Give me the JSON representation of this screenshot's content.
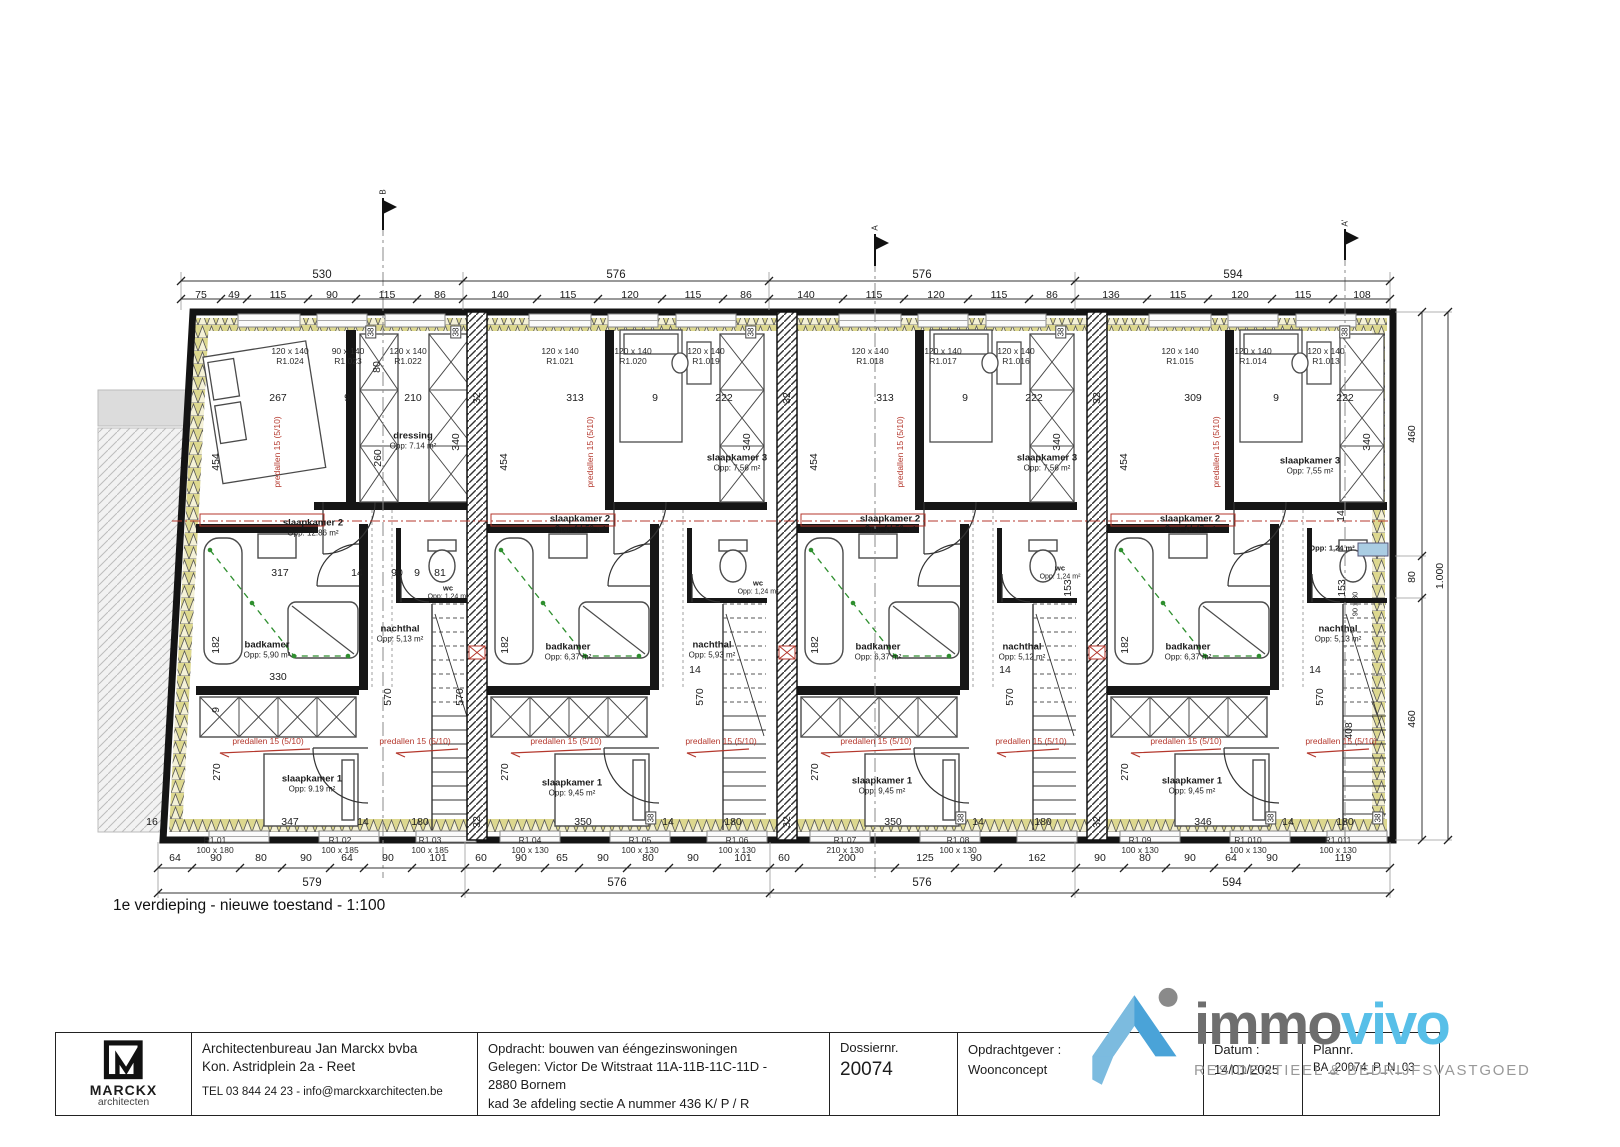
{
  "caption": "1e verdieping - nieuwe toestand - 1:100",
  "title_block": {
    "logo": {
      "brand": "MARCKX",
      "sub": "architecten"
    },
    "architect": {
      "line1": "Architectenbureau Jan Marckx bvba",
      "line2": "Kon. Astridplein 2a - Reet",
      "line3": "TEL 03 844 24 23 - info@marckxarchitecten.be"
    },
    "opdracht": {
      "line1": "Opdracht: bouwen van ééngezinswoningen",
      "line2": "Gelegen: Victor De Witstraat 11A-11B-11C-11D -",
      "line3": "2880 Bornem",
      "line4": "kad 3e afdeling sectie A nummer 436 K/ P / R"
    },
    "dossier": {
      "label": "Dossiernr.",
      "value": "20074"
    },
    "opdrachtgever": {
      "label": "Opdrachtgever :",
      "value": "Woonconcept"
    },
    "datum": {
      "label": "Datum :",
      "value": "14/01/2025"
    },
    "plannr": {
      "label": "Plannr.",
      "value": "BA_20074_P_N_03"
    }
  },
  "immovivo": {
    "immo": "immo",
    "vivo": "vivo",
    "tagline": "RESIDENTIEEL & BEDRIJFSVASTGOED"
  },
  "colors": {
    "accent_red": "#b4372c",
    "plumbing_green": "#2f8f2f",
    "brand_blue": "#58bfe8",
    "brand_gray": "#6e6e6e"
  },
  "plan_labels": [
    {
      "t": "530",
      "x": 322,
      "y": 276,
      "c": "tot"
    },
    {
      "t": "576",
      "x": 616,
      "y": 276,
      "c": "tot"
    },
    {
      "t": "576",
      "x": 922,
      "y": 276,
      "c": "tot"
    },
    {
      "t": "594",
      "x": 1233,
      "y": 276,
      "c": "tot"
    },
    {
      "t": "75",
      "x": 201,
      "y": 295
    },
    {
      "t": "49",
      "x": 234,
      "y": 295
    },
    {
      "t": "115",
      "x": 278,
      "y": 295
    },
    {
      "t": "90",
      "x": 332,
      "y": 295
    },
    {
      "t": "115",
      "x": 387,
      "y": 295
    },
    {
      "t": "86",
      "x": 440,
      "y": 295
    },
    {
      "t": "140",
      "x": 500,
      "y": 295
    },
    {
      "t": "115",
      "x": 568,
      "y": 295
    },
    {
      "t": "120",
      "x": 630,
      "y": 295
    },
    {
      "t": "115",
      "x": 693,
      "y": 295
    },
    {
      "t": "86",
      "x": 746,
      "y": 295
    },
    {
      "t": "140",
      "x": 806,
      "y": 295
    },
    {
      "t": "115",
      "x": 874,
      "y": 295
    },
    {
      "t": "120",
      "x": 936,
      "y": 295
    },
    {
      "t": "115",
      "x": 999,
      "y": 295
    },
    {
      "t": "86",
      "x": 1052,
      "y": 295
    },
    {
      "t": "136",
      "x": 1111,
      "y": 295
    },
    {
      "t": "115",
      "x": 1178,
      "y": 295
    },
    {
      "t": "120",
      "x": 1240,
      "y": 295
    },
    {
      "t": "115",
      "x": 1303,
      "y": 295
    },
    {
      "t": "108",
      "x": 1362,
      "y": 295
    },
    {
      "t": "64",
      "x": 175,
      "y": 858
    },
    {
      "t": "90",
      "x": 216,
      "y": 858
    },
    {
      "t": "80",
      "x": 261,
      "y": 858
    },
    {
      "t": "90",
      "x": 306,
      "y": 858
    },
    {
      "t": "64",
      "x": 347,
      "y": 858
    },
    {
      "t": "90",
      "x": 388,
      "y": 858
    },
    {
      "t": "101",
      "x": 438,
      "y": 858
    },
    {
      "t": "60",
      "x": 481,
      "y": 858
    },
    {
      "t": "90",
      "x": 521,
      "y": 858
    },
    {
      "t": "65",
      "x": 562,
      "y": 858
    },
    {
      "t": "90",
      "x": 603,
      "y": 858
    },
    {
      "t": "80",
      "x": 648,
      "y": 858
    },
    {
      "t": "90",
      "x": 693,
      "y": 858
    },
    {
      "t": "101",
      "x": 743,
      "y": 858
    },
    {
      "t": "60",
      "x": 784,
      "y": 858
    },
    {
      "t": "200",
      "x": 847,
      "y": 858
    },
    {
      "t": "125",
      "x": 925,
      "y": 858
    },
    {
      "t": "90",
      "x": 976,
      "y": 858
    },
    {
      "t": "162",
      "x": 1037,
      "y": 858
    },
    {
      "t": "90",
      "x": 1100,
      "y": 858
    },
    {
      "t": "80",
      "x": 1145,
      "y": 858
    },
    {
      "t": "90",
      "x": 1190,
      "y": 858
    },
    {
      "t": "64",
      "x": 1231,
      "y": 858
    },
    {
      "t": "90",
      "x": 1272,
      "y": 858
    },
    {
      "t": "119",
      "x": 1343,
      "y": 858
    },
    {
      "t": "579",
      "x": 312,
      "y": 884,
      "c": "tot"
    },
    {
      "t": "576",
      "x": 617,
      "y": 884,
      "c": "tot"
    },
    {
      "t": "576",
      "x": 922,
      "y": 884,
      "c": "tot"
    },
    {
      "t": "594",
      "x": 1232,
      "y": 884,
      "c": "tot"
    },
    {
      "t": "460",
      "x": 1412,
      "y": 434,
      "c": "rot"
    },
    {
      "t": "80",
      "x": 1412,
      "y": 577,
      "c": "rot"
    },
    {
      "t": "460",
      "x": 1412,
      "y": 719,
      "c": "rot"
    },
    {
      "t": "1.000",
      "x": 1440,
      "y": 576,
      "c": "rot"
    },
    {
      "t": "16",
      "x": 152,
      "y": 822
    },
    {
      "t": "267",
      "x": 278,
      "y": 398
    },
    {
      "t": "9",
      "x": 347,
      "y": 398
    },
    {
      "t": "210",
      "x": 413,
      "y": 398
    },
    {
      "t": "313",
      "x": 575,
      "y": 398
    },
    {
      "t": "9",
      "x": 655,
      "y": 398
    },
    {
      "t": "222",
      "x": 724,
      "y": 398
    },
    {
      "t": "313",
      "x": 885,
      "y": 398
    },
    {
      "t": "9",
      "x": 965,
      "y": 398
    },
    {
      "t": "222",
      "x": 1034,
      "y": 398
    },
    {
      "t": "309",
      "x": 1193,
      "y": 398
    },
    {
      "t": "9",
      "x": 1276,
      "y": 398
    },
    {
      "t": "222",
      "x": 1345,
      "y": 398
    },
    {
      "t": "454",
      "x": 216,
      "y": 462,
      "c": "rot"
    },
    {
      "t": "454",
      "x": 504,
      "y": 462,
      "c": "rot"
    },
    {
      "t": "454",
      "x": 814,
      "y": 462,
      "c": "rot"
    },
    {
      "t": "454",
      "x": 1124,
      "y": 462,
      "c": "rot"
    },
    {
      "t": "260",
      "x": 378,
      "y": 458,
      "c": "rot"
    },
    {
      "t": "80",
      "x": 377,
      "y": 367,
      "c": "rot"
    },
    {
      "t": "340",
      "x": 456,
      "y": 442,
      "c": "rot"
    },
    {
      "t": "340",
      "x": 747,
      "y": 442,
      "c": "rot"
    },
    {
      "t": "340",
      "x": 1057,
      "y": 442,
      "c": "rot"
    },
    {
      "t": "340",
      "x": 1367,
      "y": 442,
      "c": "rot"
    },
    {
      "t": "38",
      "x": 371,
      "y": 332,
      "c": "box"
    },
    {
      "t": "38",
      "x": 456,
      "y": 332,
      "c": "box"
    },
    {
      "t": "38",
      "x": 751,
      "y": 332,
      "c": "box"
    },
    {
      "t": "38",
      "x": 1061,
      "y": 332,
      "c": "box"
    },
    {
      "t": "38",
      "x": 1345,
      "y": 332,
      "c": "box"
    },
    {
      "t": "38",
      "x": 651,
      "y": 818,
      "c": "box"
    },
    {
      "t": "38",
      "x": 961,
      "y": 818,
      "c": "box"
    },
    {
      "t": "38",
      "x": 1271,
      "y": 818,
      "c": "box"
    },
    {
      "t": "38",
      "x": 1378,
      "y": 818,
      "c": "box"
    },
    {
      "t": "32",
      "x": 477,
      "y": 398,
      "c": "rot"
    },
    {
      "t": "32",
      "x": 787,
      "y": 398,
      "c": "rot"
    },
    {
      "t": "32",
      "x": 1097,
      "y": 398,
      "c": "rot"
    },
    {
      "t": "32",
      "x": 477,
      "y": 822,
      "c": "rot"
    },
    {
      "t": "32",
      "x": 787,
      "y": 822,
      "c": "rot"
    },
    {
      "t": "32",
      "x": 1097,
      "y": 822,
      "c": "rot"
    },
    {
      "t": "317",
      "x": 280,
      "y": 573
    },
    {
      "t": "14",
      "x": 357,
      "y": 573
    },
    {
      "t": "90",
      "x": 397,
      "y": 573
    },
    {
      "t": "9",
      "x": 417,
      "y": 573
    },
    {
      "t": "81",
      "x": 440,
      "y": 573
    },
    {
      "t": "182",
      "x": 216,
      "y": 645,
      "c": "rot"
    },
    {
      "t": "182",
      "x": 505,
      "y": 645,
      "c": "rot"
    },
    {
      "t": "182",
      "x": 815,
      "y": 645,
      "c": "rot"
    },
    {
      "t": "182",
      "x": 1125,
      "y": 645,
      "c": "rot"
    },
    {
      "t": "330",
      "x": 278,
      "y": 677
    },
    {
      "t": "570",
      "x": 388,
      "y": 697,
      "c": "rot"
    },
    {
      "t": "570",
      "x": 460,
      "y": 697,
      "c": "rot"
    },
    {
      "t": "570",
      "x": 700,
      "y": 697,
      "c": "rot"
    },
    {
      "t": "570",
      "x": 1010,
      "y": 697,
      "c": "rot"
    },
    {
      "t": "570",
      "x": 1320,
      "y": 697,
      "c": "rot"
    },
    {
      "t": "14",
      "x": 695,
      "y": 670
    },
    {
      "t": "14",
      "x": 1005,
      "y": 670
    },
    {
      "t": "14",
      "x": 1315,
      "y": 670
    },
    {
      "t": "9",
      "x": 216,
      "y": 710,
      "c": "rot"
    },
    {
      "t": "270",
      "x": 217,
      "y": 772,
      "c": "rot"
    },
    {
      "t": "270",
      "x": 505,
      "y": 772,
      "c": "rot"
    },
    {
      "t": "270",
      "x": 815,
      "y": 772,
      "c": "rot"
    },
    {
      "t": "270",
      "x": 1125,
      "y": 772,
      "c": "rot"
    },
    {
      "t": "347",
      "x": 290,
      "y": 822
    },
    {
      "t": "14",
      "x": 363,
      "y": 822
    },
    {
      "t": "180",
      "x": 420,
      "y": 822
    },
    {
      "t": "350",
      "x": 583,
      "y": 822
    },
    {
      "t": "14",
      "x": 668,
      "y": 822
    },
    {
      "t": "180",
      "x": 733,
      "y": 822
    },
    {
      "t": "350",
      "x": 893,
      "y": 822
    },
    {
      "t": "14",
      "x": 978,
      "y": 822
    },
    {
      "t": "180",
      "x": 1043,
      "y": 822
    },
    {
      "t": "346",
      "x": 1203,
      "y": 822
    },
    {
      "t": "14",
      "x": 1288,
      "y": 822
    },
    {
      "t": "180",
      "x": 1345,
      "y": 822
    },
    {
      "t": "153",
      "x": 1068,
      "y": 588,
      "c": "rot"
    },
    {
      "t": "153",
      "x": 1342,
      "y": 588,
      "c": "rot"
    },
    {
      "t": "90 x 80",
      "x": 1356,
      "y": 604,
      "c": "tinyrot"
    },
    {
      "t": "408",
      "x": 1349,
      "y": 731,
      "c": "rot"
    },
    {
      "t": "14",
      "x": 1341,
      "y": 516,
      "c": "rot"
    },
    {
      "t": "120 x 140",
      "t2": "R1.024",
      "x": 290,
      "y": 356,
      "c": "win",
      "n": "window-label"
    },
    {
      "t": "90 x 140",
      "t2": "R1.023",
      "x": 348,
      "y": 356,
      "c": "win",
      "n": "window-label"
    },
    {
      "t": "120 x 140",
      "t2": "R1.022",
      "x": 408,
      "y": 356,
      "c": "win",
      "n": "window-label"
    },
    {
      "t": "120 x 140",
      "t2": "R1.021",
      "x": 560,
      "y": 356,
      "c": "win",
      "n": "window-label"
    },
    {
      "t": "120 x 140",
      "t2": "R1.020",
      "x": 633,
      "y": 356,
      "c": "win",
      "n": "window-label"
    },
    {
      "t": "120 x 140",
      "t2": "R1.019",
      "x": 706,
      "y": 356,
      "c": "win",
      "n": "window-label"
    },
    {
      "t": "120 x 140",
      "t2": "R1.018",
      "x": 870,
      "y": 356,
      "c": "win",
      "n": "window-label"
    },
    {
      "t": "120 x 140",
      "t2": "R1.017",
      "x": 943,
      "y": 356,
      "c": "win",
      "n": "window-label"
    },
    {
      "t": "120 x 140",
      "t2": "R1.016",
      "x": 1016,
      "y": 356,
      "c": "win",
      "n": "window-label"
    },
    {
      "t": "120 x 140",
      "t2": "R1.015",
      "x": 1180,
      "y": 356,
      "c": "win",
      "n": "window-label"
    },
    {
      "t": "120 x 140",
      "t2": "R1.014",
      "x": 1253,
      "y": 356,
      "c": "win",
      "n": "window-label"
    },
    {
      "t": "120 x 140",
      "t2": "R1.013",
      "x": 1326,
      "y": 356,
      "c": "win",
      "n": "window-label"
    },
    {
      "t": "R1.01",
      "t2": "100 x 180",
      "x": 215,
      "y": 845,
      "c": "win",
      "n": "window-label"
    },
    {
      "t": "R1.02",
      "t2": "100 x 185",
      "x": 340,
      "y": 845,
      "c": "win",
      "n": "window-label"
    },
    {
      "t": "R1.03",
      "t2": "100 x 185",
      "x": 430,
      "y": 845,
      "c": "win",
      "n": "window-label"
    },
    {
      "t": "R1.04",
      "t2": "100 x 130",
      "x": 530,
      "y": 845,
      "c": "win",
      "n": "window-label"
    },
    {
      "t": "R1.05",
      "t2": "100 x 130",
      "x": 640,
      "y": 845,
      "c": "win",
      "n": "window-label"
    },
    {
      "t": "R1.06",
      "t2": "100 x 130",
      "x": 737,
      "y": 845,
      "c": "win",
      "n": "window-label"
    },
    {
      "t": "R1.07",
      "t2": "210 x 130",
      "x": 845,
      "y": 845,
      "c": "win",
      "n": "window-label"
    },
    {
      "t": "R1.08",
      "t2": "100 x 130",
      "x": 958,
      "y": 845,
      "c": "win",
      "n": "window-label"
    },
    {
      "t": "R1.09",
      "t2": "100 x 130",
      "x": 1140,
      "y": 845,
      "c": "win",
      "n": "window-label"
    },
    {
      "t": "R1.010",
      "t2": "100 x 130",
      "x": 1248,
      "y": 845,
      "c": "win",
      "n": "window-label"
    },
    {
      "t": "R1.011",
      "t2": "100 x 130",
      "x": 1338,
      "y": 845,
      "c": "win",
      "n": "window-label"
    },
    {
      "t": "slaapkamer 2",
      "t2": "Opp: 12.86 m²",
      "x": 313,
      "y": 528,
      "c": "room",
      "n": "room-label"
    },
    {
      "t": "slaapkamer 2",
      "t2": "Opp: 14,58 m²",
      "x": 580,
      "y": 524,
      "c": "room",
      "n": "room-label"
    },
    {
      "t": "slaapkamer 2",
      "t2": "Opp: 14,59 m²",
      "x": 890,
      "y": 524,
      "c": "room",
      "n": "room-label"
    },
    {
      "t": "slaapkamer 2",
      "t2": "Opp: 14.47 m²",
      "x": 1190,
      "y": 524,
      "c": "room",
      "n": "room-label"
    },
    {
      "t": "dressing",
      "t2": "Opp: 7.14 m²",
      "x": 413,
      "y": 441,
      "c": "room",
      "n": "room-label"
    },
    {
      "t": "slaapkamer 3",
      "t2": "Opp: 7,56 m²",
      "x": 737,
      "y": 463,
      "c": "room",
      "n": "room-label"
    },
    {
      "t": "slaapkamer 3",
      "t2": "Opp: 7,56 m²",
      "x": 1047,
      "y": 463,
      "c": "room",
      "n": "room-label"
    },
    {
      "t": "slaapkamer 3",
      "t2": "Opp: 7,55 m²",
      "x": 1310,
      "y": 466,
      "c": "room",
      "n": "room-label"
    },
    {
      "t": "badkamer",
      "t2": "Opp: 5,90 m²",
      "x": 267,
      "y": 650,
      "c": "room",
      "n": "room-label"
    },
    {
      "t": "badkamer",
      "t2": "Opp: 6,37 m²",
      "x": 568,
      "y": 652,
      "c": "room",
      "n": "room-label"
    },
    {
      "t": "badkamer",
      "t2": "Opp: 6,37 m²",
      "x": 878,
      "y": 652,
      "c": "room",
      "n": "room-label"
    },
    {
      "t": "badkamer",
      "t2": "Opp: 6,37 m²",
      "x": 1188,
      "y": 652,
      "c": "room",
      "n": "room-label"
    },
    {
      "t": "nachthal",
      "t2": "Opp: 5,13 m²",
      "x": 400,
      "y": 634,
      "c": "room",
      "n": "room-label"
    },
    {
      "t": "nachthal",
      "t2": "Opp: 5,93 m²",
      "x": 712,
      "y": 650,
      "c": "room",
      "n": "room-label"
    },
    {
      "t": "nachthal",
      "t2": "Opp: 5,12 m²",
      "x": 1022,
      "y": 652,
      "c": "room",
      "n": "room-label"
    },
    {
      "t": "nachthal",
      "t2": "Opp: 5,13 m²",
      "x": 1338,
      "y": 634,
      "c": "room",
      "n": "room-label"
    },
    {
      "t": "slaapkamer 1",
      "t2": "Opp: 9.19 m²",
      "x": 312,
      "y": 784,
      "c": "room",
      "n": "room-label"
    },
    {
      "t": "slaapkamer 1",
      "t2": "Opp: 9,45 m²",
      "x": 572,
      "y": 788,
      "c": "room",
      "n": "room-label"
    },
    {
      "t": "slaapkamer 1",
      "t2": "Opp: 9,45 m²",
      "x": 882,
      "y": 786,
      "c": "room",
      "n": "room-label"
    },
    {
      "t": "slaapkamer 1",
      "t2": "Opp: 9,45 m²",
      "x": 1192,
      "y": 786,
      "c": "room",
      "n": "room-label"
    },
    {
      "t": "wc",
      "t2": "Opp: 1.24 m²",
      "x": 448,
      "y": 593,
      "c": "tiny",
      "n": "room-label"
    },
    {
      "t": "wc",
      "t2": "Opp: 1,24 m²",
      "x": 758,
      "y": 588,
      "c": "tiny",
      "n": "room-label"
    },
    {
      "t": "wc",
      "t2": "Opp: 1,24 m²",
      "x": 1060,
      "y": 573,
      "c": "tiny",
      "n": "room-label"
    },
    {
      "t": "Opp: 1,24 m²",
      "x": 1332,
      "y": 549,
      "c": "tiny",
      "n": "room-label"
    },
    {
      "t": "predallen 15 (5/10)",
      "x": 277,
      "y": 452,
      "c": "redrot"
    },
    {
      "t": "predallen 15 (5/10)",
      "x": 590,
      "y": 452,
      "c": "redrot"
    },
    {
      "t": "predallen 15 (5/10)",
      "x": 900,
      "y": 452,
      "c": "redrot"
    },
    {
      "t": "predallen 15 (5/10)",
      "x": 1216,
      "y": 452,
      "c": "redrot"
    },
    {
      "t": "predallen 15 (5/10)",
      "x": 268,
      "y": 741,
      "c": "red"
    },
    {
      "t": "predallen 15 (5/10)",
      "x": 415,
      "y": 741,
      "c": "red"
    },
    {
      "t": "predallen 15 (5/10)",
      "x": 566,
      "y": 741,
      "c": "red"
    },
    {
      "t": "predallen 15 (5/10)",
      "x": 721,
      "y": 741,
      "c": "red"
    },
    {
      "t": "predallen 15 (5/10)",
      "x": 876,
      "y": 741,
      "c": "red"
    },
    {
      "t": "predallen 15 (5/10)",
      "x": 1031,
      "y": 741,
      "c": "red"
    },
    {
      "t": "predallen 15 (5/10)",
      "x": 1186,
      "y": 741,
      "c": "red"
    },
    {
      "t": "predallen 15 (5/10)",
      "x": 1341,
      "y": 741,
      "c": "red"
    },
    {
      "t": "B",
      "x": 383,
      "y": 192,
      "c": "flag",
      "n": "section-marker-label"
    },
    {
      "t": "A",
      "x": 875,
      "y": 228,
      "c": "flag",
      "n": "section-marker-label"
    },
    {
      "t": "A'",
      "x": 1345,
      "y": 223,
      "c": "flag",
      "n": "section-marker-label"
    }
  ]
}
